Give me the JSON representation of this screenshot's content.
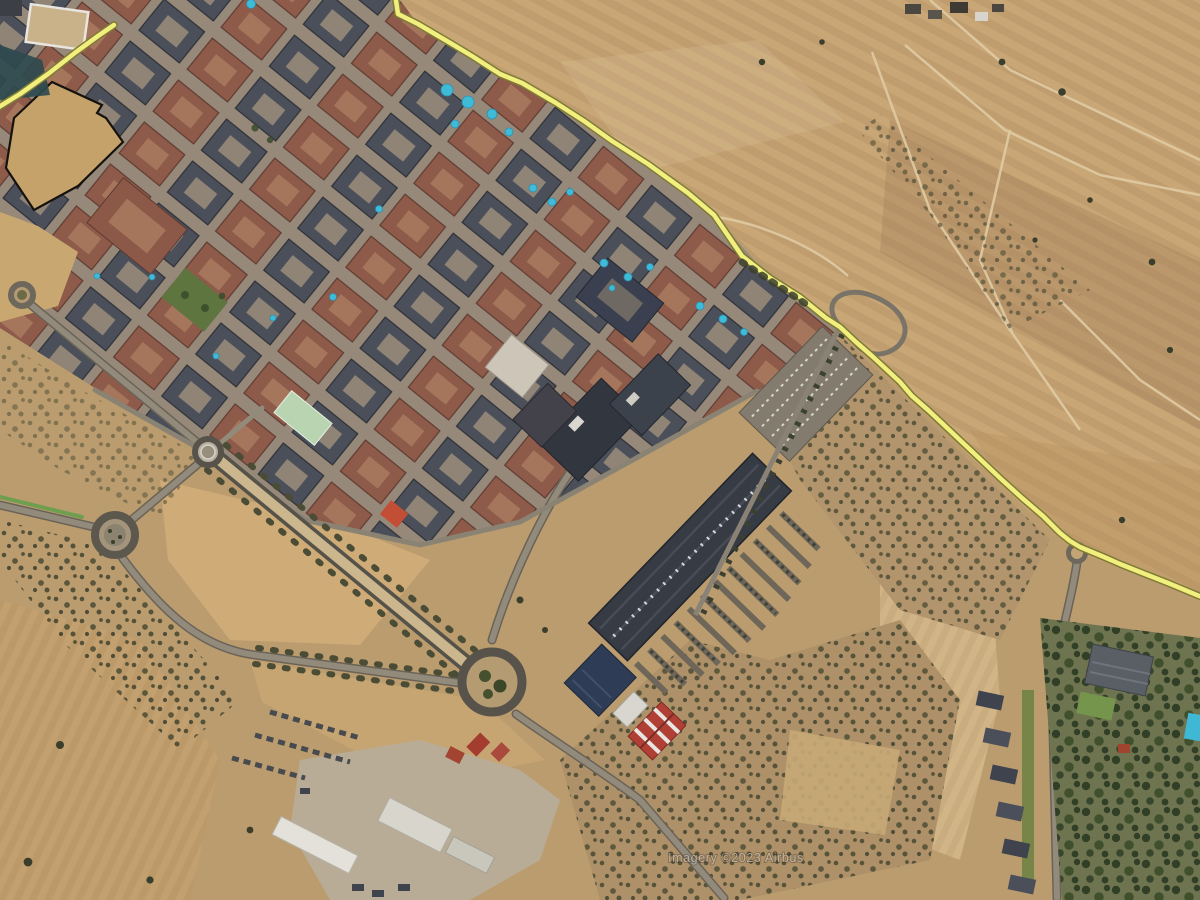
{
  "map": {
    "attribution": "Imagery ©2023 Airbus",
    "view": "satellite-aerial",
    "palette": {
      "route_highlight": "#f2ef7f",
      "route_casing": "#7d7b35",
      "field_tan": "#c9a676",
      "plowed_brown": "#8a6b49",
      "city_street": "#97897a",
      "block_dark": "#4a4f5a",
      "block_terracotta": "#8e5a49",
      "mall_roof": "#363b44",
      "pool_blue": "#3fbbd8",
      "scrub_bush": "#3a3e2b",
      "tree_green": "#2c3a22",
      "road_gray": "#928b7c",
      "warehouse_white": "#e3e1da",
      "red_roof": "#b04036",
      "parcel_outline": "#15120e"
    },
    "route": {
      "segment_top_left_points": "-6,110 20,94 48,74 76,52 98,36 114,25",
      "segment_main_points": "395,-6 398,14 418,24 452,44 472,56 500,74 522,83 556,103 584,121 612,141 648,164 688,193 714,215 742,256 770,278 800,297 826,318 840,327 856,342 872,356 886,369 900,382 912,396 928,410 944,425 962,442 980,459 1000,478 1022,498 1043,516 1060,533 1070,541 1080,547 1092,552 1104,557 1120,564 1140,572 1168,583 1204,598"
    }
  }
}
